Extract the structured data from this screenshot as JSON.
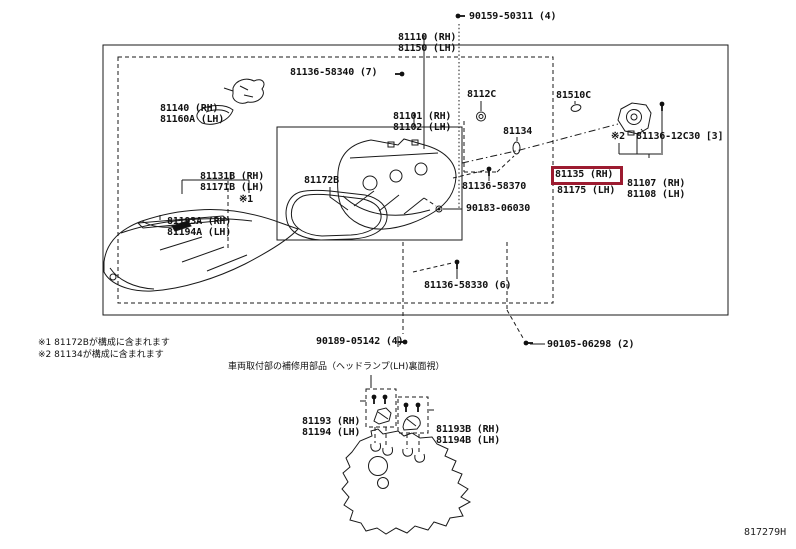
{
  "page": {
    "doc_code": "817279H",
    "highlight_color": "#9c1b30"
  },
  "parts": {
    "p81110": {
      "l1": "81110 (RH)",
      "l2": "81150 (LH)"
    },
    "f90159": "90159-50311 (4)",
    "p81140": {
      "l1": "81140 (RH)",
      "l2": "81160A (LH)"
    },
    "f58340": "81136-58340 (7)",
    "p81101": {
      "l1": "81101 (RH)",
      "l2": "81102 (LH)"
    },
    "p8112C": "8112C",
    "p81510C": "81510C",
    "p81134": "81134",
    "f12C30": "81136-12C30 [3]",
    "p81107": {
      "l1": "81107 (RH)",
      "l2": "81108 (LH)"
    },
    "p81135": {
      "l1": "81135 (RH)",
      "l2": "81175 (LH)"
    },
    "p81131B": {
      "l1": "81131B (RH)",
      "l2": "81171B (LH)"
    },
    "p81193A": {
      "l1": "81193A (RH)",
      "l2": "81194A (LH)"
    },
    "p81172B": "81172B",
    "f58370": "81136-58370",
    "f90183": "90183-06030",
    "f58330": "81136-58330 (6)",
    "f90189": "90189-05142 (4)",
    "f90105": "90105-06298 (2)"
  },
  "notes": {
    "note1_mark": "※1",
    "note2_mark": "※2",
    "note1": "※1 81172Bが構成に含まれます",
    "note2": "※2 81134が構成に含まれます"
  },
  "bottom": {
    "title": "車両取付部の補修用部品（ヘッドランプ(LH)裏面視）",
    "p81193": {
      "l1": "81193 (RH)",
      "l2": "81194 (LH)"
    },
    "p81193B": {
      "l1": "81193B (RH)",
      "l2": "81194B (LH)"
    }
  }
}
